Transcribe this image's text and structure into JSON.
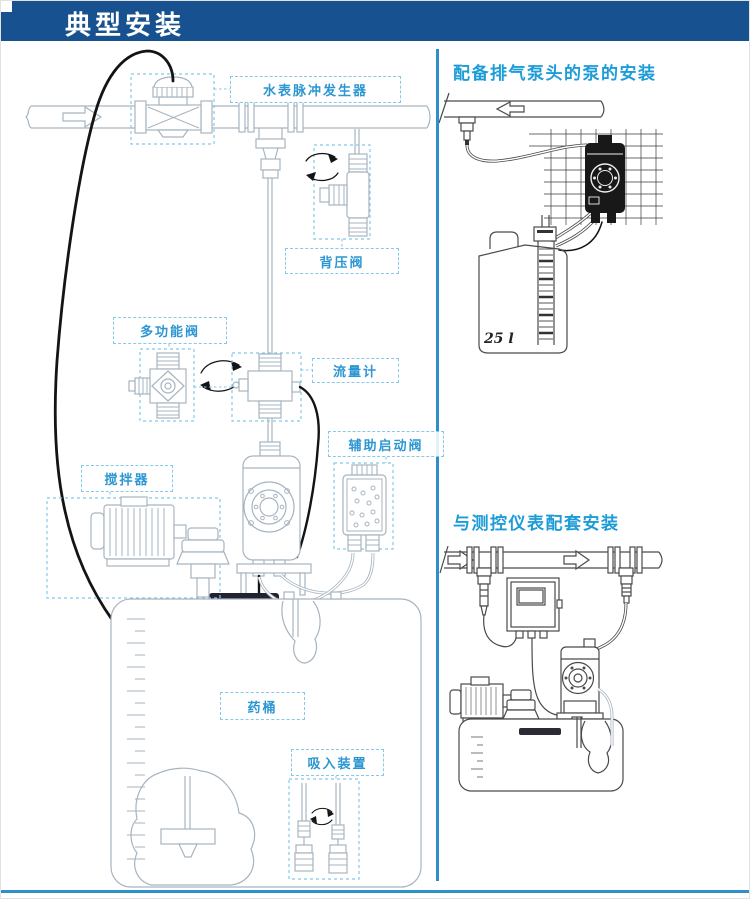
{
  "header": {
    "title": "典型安装"
  },
  "left_diagram": {
    "labels": {
      "water_meter_pulse": "水表脉冲发生器",
      "back_pressure_valve": "背压阀",
      "multifunction_valve": "多功能阀",
      "flow_meter": "流量计",
      "auxiliary_start_valve": "辅助启动阀",
      "agitator": "搅拌器",
      "chemical_tank": "药桶",
      "suction_device": "吸入装置"
    }
  },
  "right_top_diagram": {
    "title": "配备排气泵头的泵的安装",
    "tank_capacity_label": "25 l"
  },
  "right_bottom_diagram": {
    "title": "与测控仪表配套安装"
  },
  "colors": {
    "header_bg": "#17518f",
    "accent_blue": "#1e9cd8",
    "label_text": "#2b96d2",
    "label_border": "#85c8ea",
    "divider": "#2e8fc9"
  }
}
